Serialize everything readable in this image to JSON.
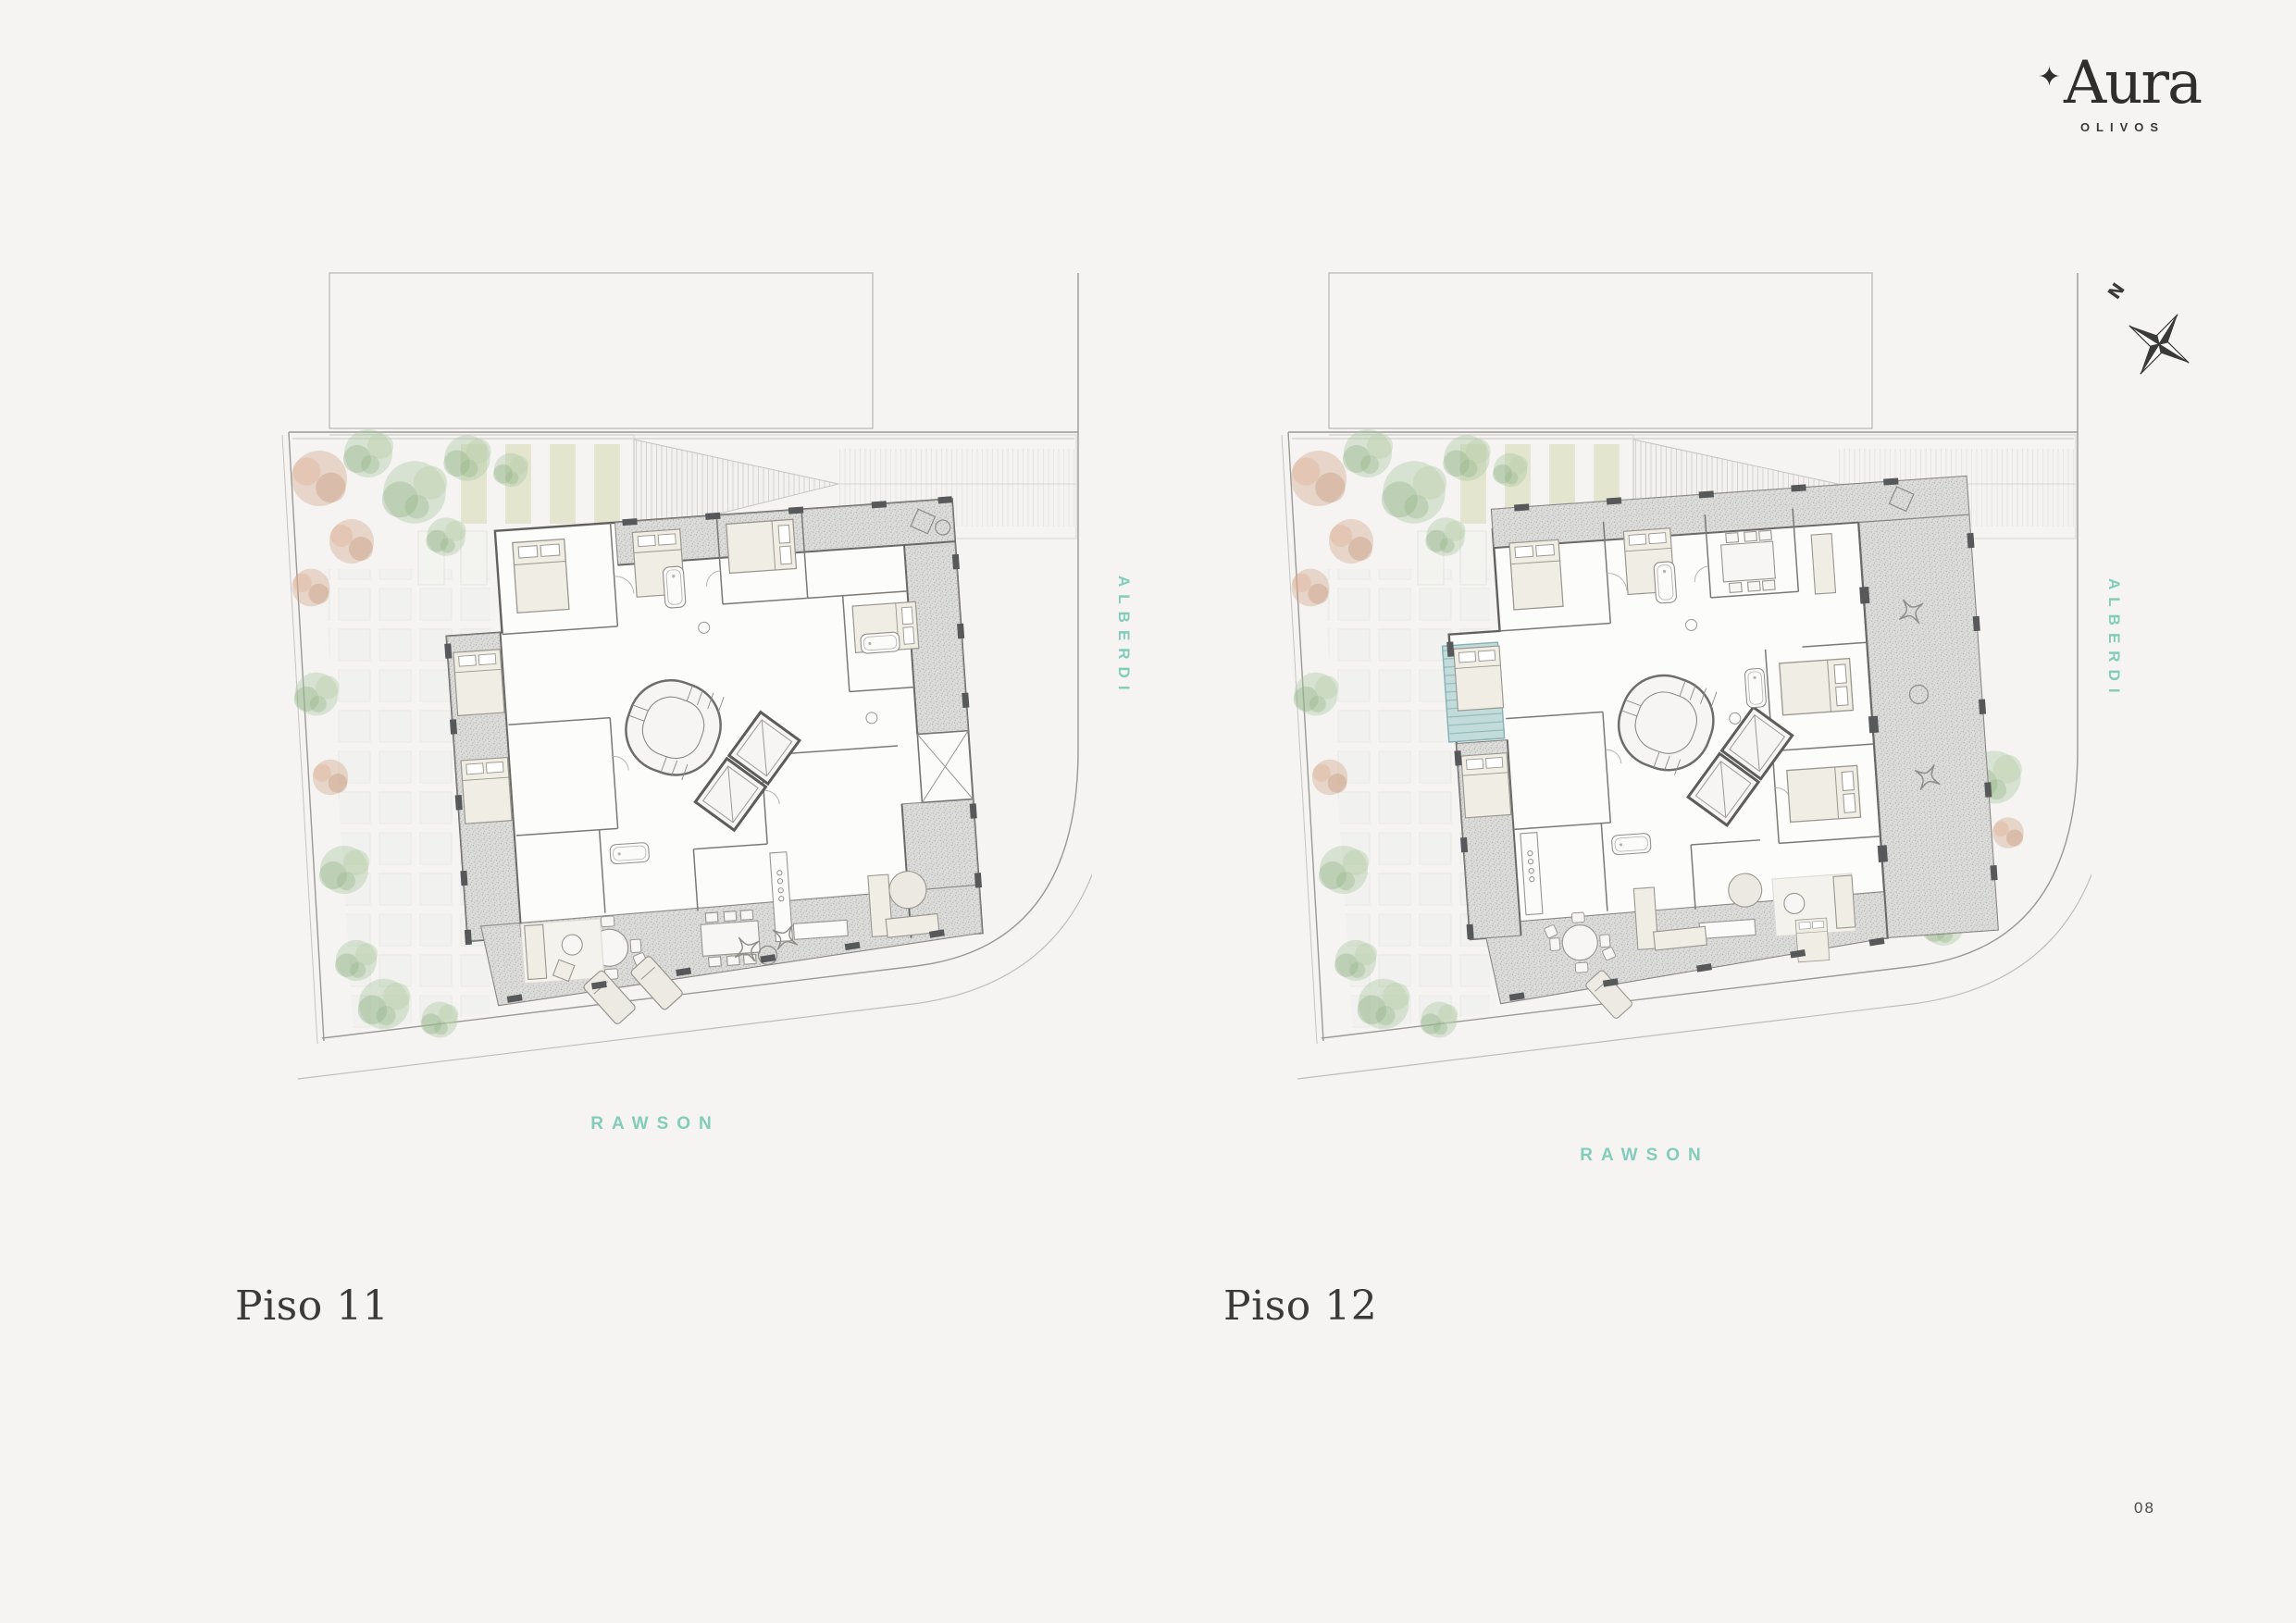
{
  "logo": {
    "star": "✦",
    "brand": "Aura",
    "sub": "OLIVOS"
  },
  "compass": {
    "north_label": "N"
  },
  "plans": [
    {
      "title": "Piso 11",
      "street_right": "ALBERDI",
      "street_bottom": "RAWSON"
    },
    {
      "title": "Piso 12",
      "street_right": "ALBERDI",
      "street_bottom": "RAWSON"
    }
  ],
  "page": {
    "number": "08"
  },
  "colors": {
    "background": "#f5f4f2",
    "accent_teal": "#82cdb9",
    "ink": "#3b3a38",
    "plan_line": "#9b9995",
    "wall": "#61605c",
    "balcony_fill": "#dcdcdb",
    "pool": "#c3dcdb",
    "planter_olive": "#d0d5ab",
    "foliage_green": "#a9c49d",
    "foliage_rust": "#d0a387"
  }
}
